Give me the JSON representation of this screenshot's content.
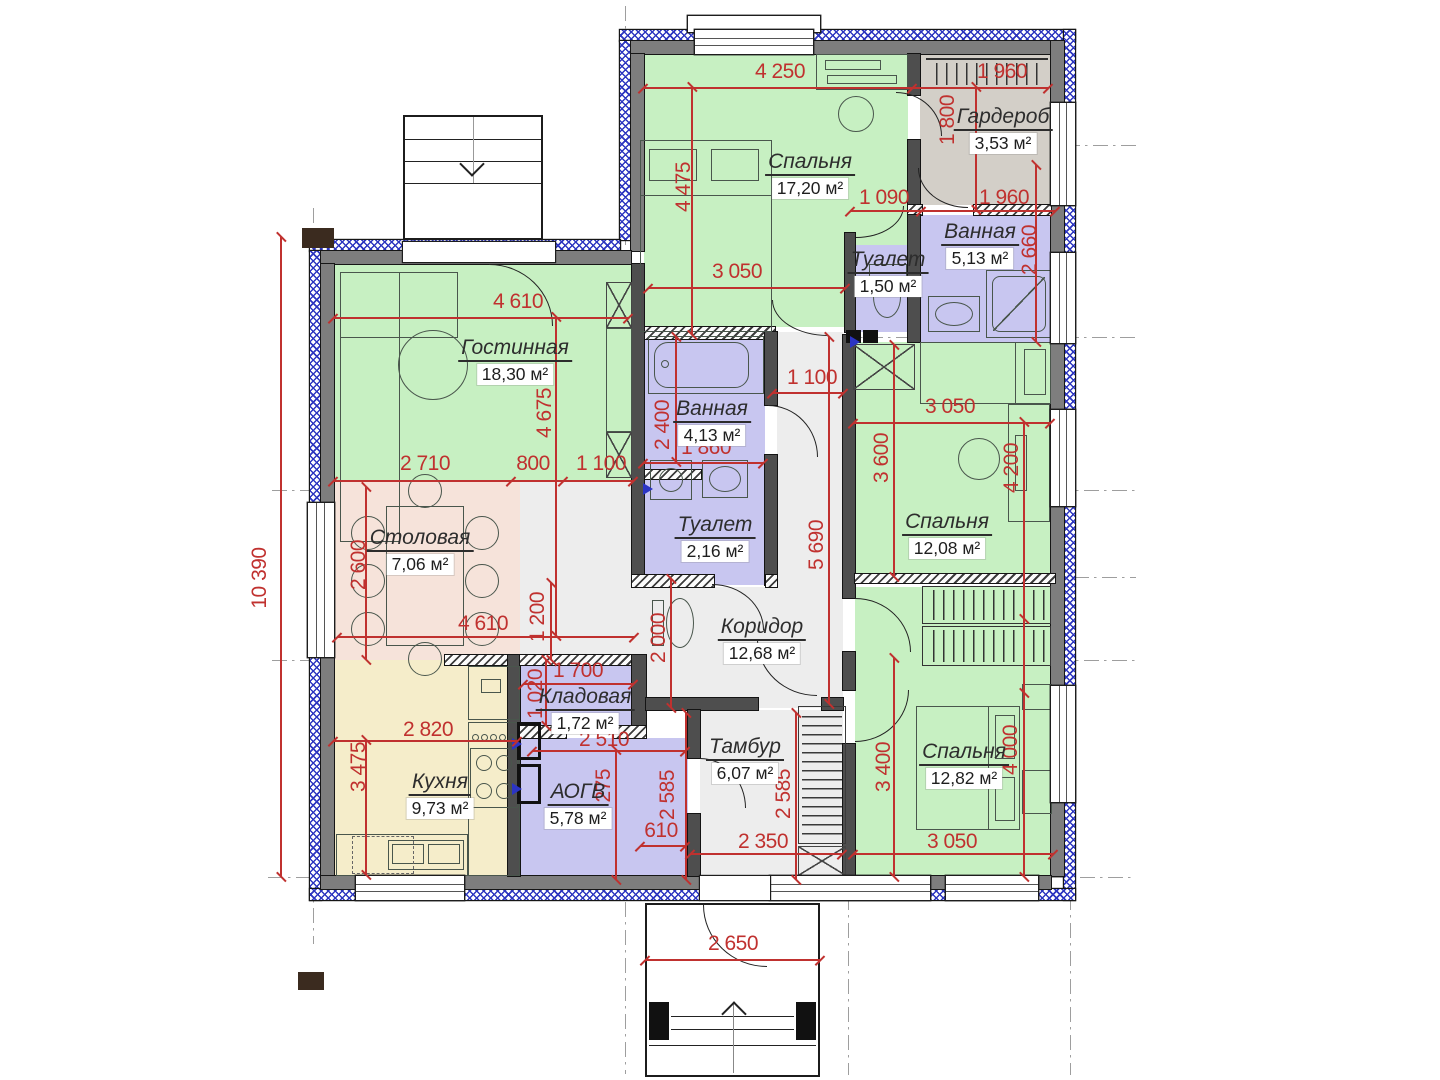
{
  "palette": {
    "room_green": "#c7f0c2",
    "room_purple": "#c8c6f0",
    "room_peach": "#f6e3da",
    "room_yellow": "#f5edca",
    "room_gray": "#d3cfc8",
    "room_corridor": "#ededed",
    "wall": "#4e4e4e",
    "insulation_blue": "#2d36c0",
    "dimension_red": "#c0312f"
  },
  "rooms": [
    {
      "name": "Спальня",
      "area": "17,20 м²"
    },
    {
      "name": "Гардероб",
      "area": "3,53 м²"
    },
    {
      "name": "Ванная",
      "area": "5,13 м²"
    },
    {
      "name": "Туалет",
      "area": "1,50 м²"
    },
    {
      "name": "Гостинная",
      "area": "18,30 м²"
    },
    {
      "name": "Ванная",
      "area": "4,13 м²"
    },
    {
      "name": "Туалет",
      "area": "2,16 м²"
    },
    {
      "name": "Спальня",
      "area": "12,08 м²"
    },
    {
      "name": "Столовая",
      "area": "7,06 м²"
    },
    {
      "name": "Коридор",
      "area": "12,68 м²"
    },
    {
      "name": "Кладовая",
      "area": "1,72 м²"
    },
    {
      "name": "Кухня",
      "area": "9,73 м²"
    },
    {
      "name": "АОГВ",
      "area": "5,78 м²"
    },
    {
      "name": "Тамбур",
      "area": "6,07 м²"
    },
    {
      "name": "Спальня",
      "area": "12,82 м²"
    }
  ],
  "dims": [
    "4 250",
    "1 960",
    "1 800",
    "4 475",
    "1 090",
    "1 960",
    "2 660",
    "3 050",
    "4 610",
    "4 675",
    "1 100",
    "2 400",
    "1 860",
    "3 600",
    "3 050",
    "4 200",
    "2 710",
    "800",
    "1 100",
    "2 600",
    "5 690",
    "4 610",
    "1 200",
    "2 000",
    "1 700",
    "1 020",
    "2 510",
    "2 820",
    "3 475",
    "2 275",
    "2 585",
    "610",
    "2 585",
    "2 350",
    "3 400",
    "4 000",
    "3 050",
    "2 650",
    "10 390"
  ]
}
